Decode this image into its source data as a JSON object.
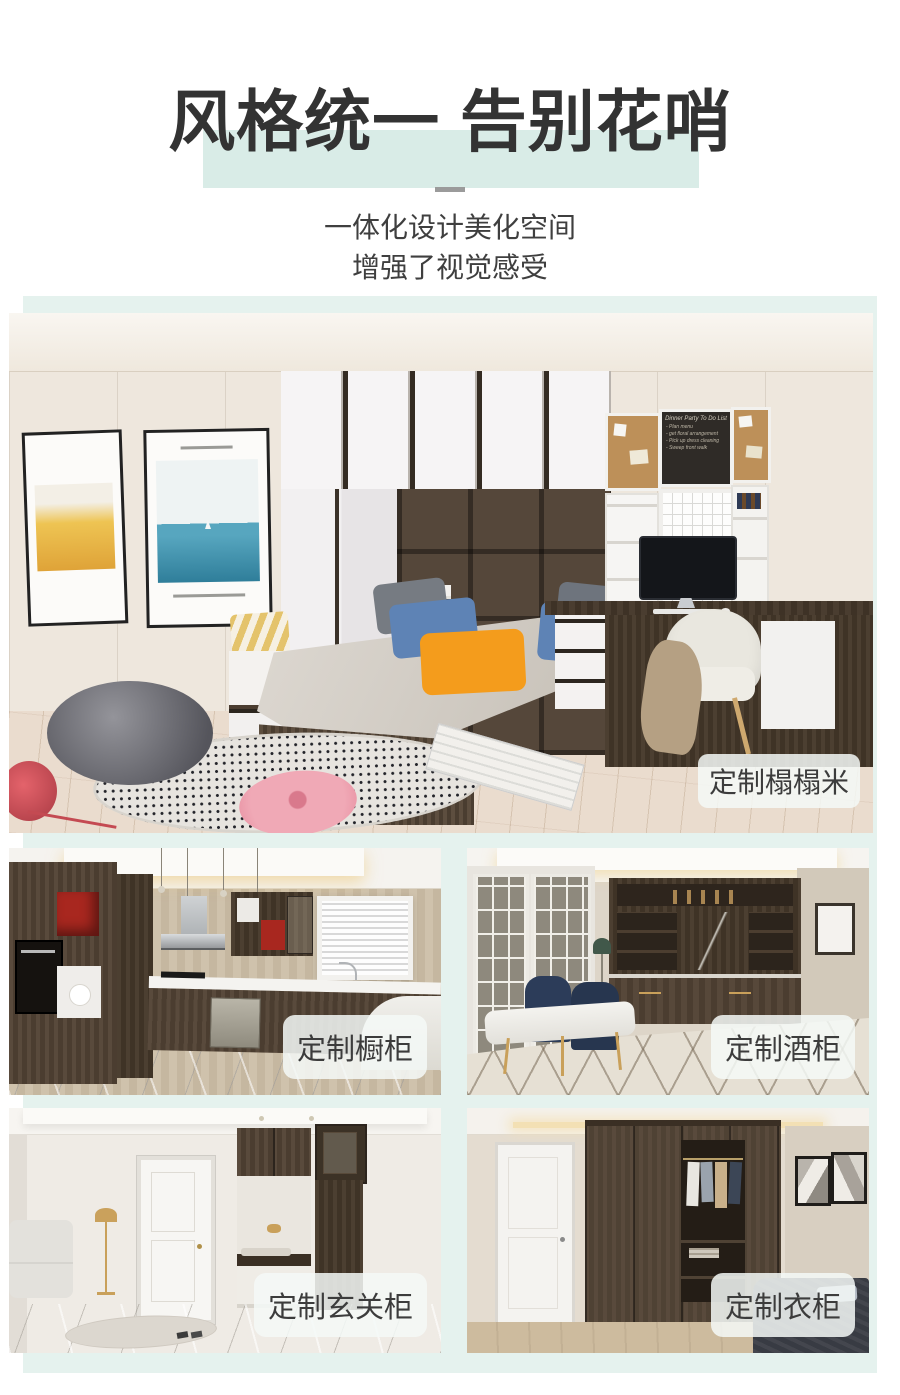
{
  "header": {
    "title": "风格统一 告别花哨",
    "subtitle_line1": "一体化设计美化空间",
    "subtitle_line2": "增强了视觉感受"
  },
  "photos": [
    {
      "name": "tatami-room",
      "label": "定制榻榻米"
    },
    {
      "name": "kitchen",
      "label": "定制橱柜"
    },
    {
      "name": "wine-cabinet-room",
      "label": "定制酒柜"
    },
    {
      "name": "entryway",
      "label": "定制玄关柜"
    },
    {
      "name": "wardrobe-room",
      "label": "定制衣柜"
    }
  ],
  "memo_board": {
    "title": "Dinner Party To Do List",
    "items": [
      "- Plan menu",
      "- get floral arrangement",
      "- Pick up dress cleaning",
      "- Sweep front walk"
    ]
  },
  "colors": {
    "accent_mint": "#e5f2ee",
    "title_highlight": "#d9ece7",
    "title_color": "#333333",
    "subtitle_color": "#3f3f3f",
    "divider": "#9b9b9b",
    "pill_bg": "rgba(244,249,247,0.85)",
    "pill_text": "#3c3c3c"
  }
}
